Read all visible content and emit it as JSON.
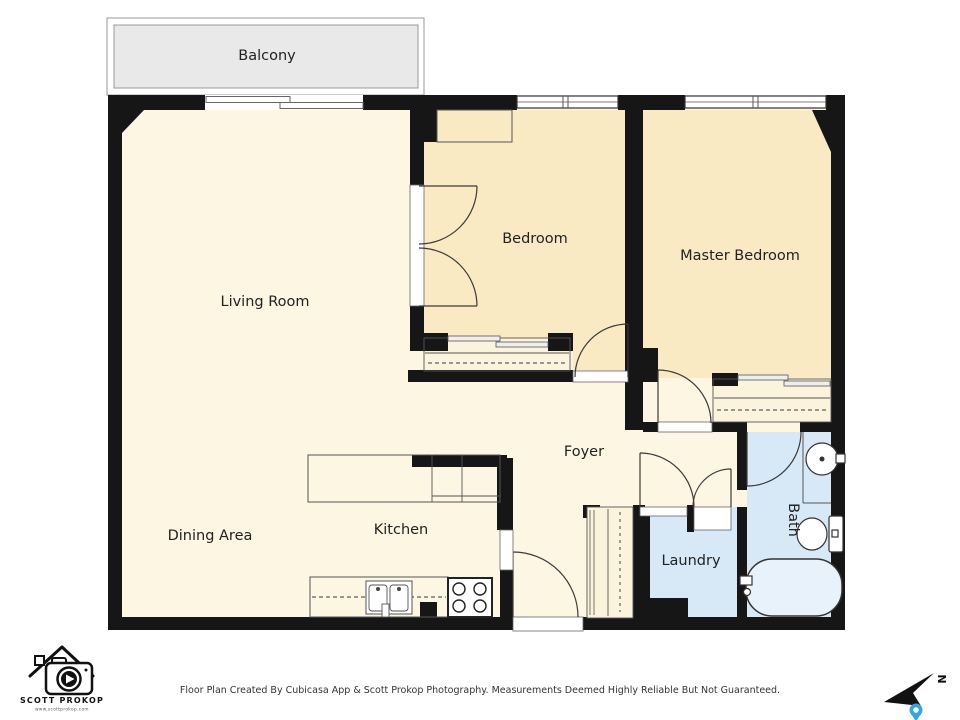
{
  "rooms": {
    "balcony": "Balcony",
    "living_room": "Living Room",
    "dining_area": "Dining Area",
    "kitchen": "Kitchen",
    "foyer": "Foyer",
    "bedroom": "Bedroom",
    "master_bedroom": "Master Bedroom",
    "laundry": "Laundry",
    "bath": "Bath"
  },
  "branding": {
    "logo_name": "SCOTT PROKOP",
    "logo_url": "www.scottprokop.com"
  },
  "footer": {
    "disclaimer": "Floor Plan Created By Cubicasa App & Scott Prokop Photography. Measurements Deemed Highly Reliable But Not Guaranteed."
  },
  "compass": {
    "north_label": "N"
  },
  "colors": {
    "wall": "#161616",
    "floor": "#FCF6E2",
    "bedroom_floor": "#F9EAC4",
    "closet_floor": "#FBF3DC",
    "wet_floor": "#D7E9F7",
    "balcony": "#E9E9EA",
    "tub_fill": "#E8F2FB",
    "pin": "#2FA8E0"
  }
}
